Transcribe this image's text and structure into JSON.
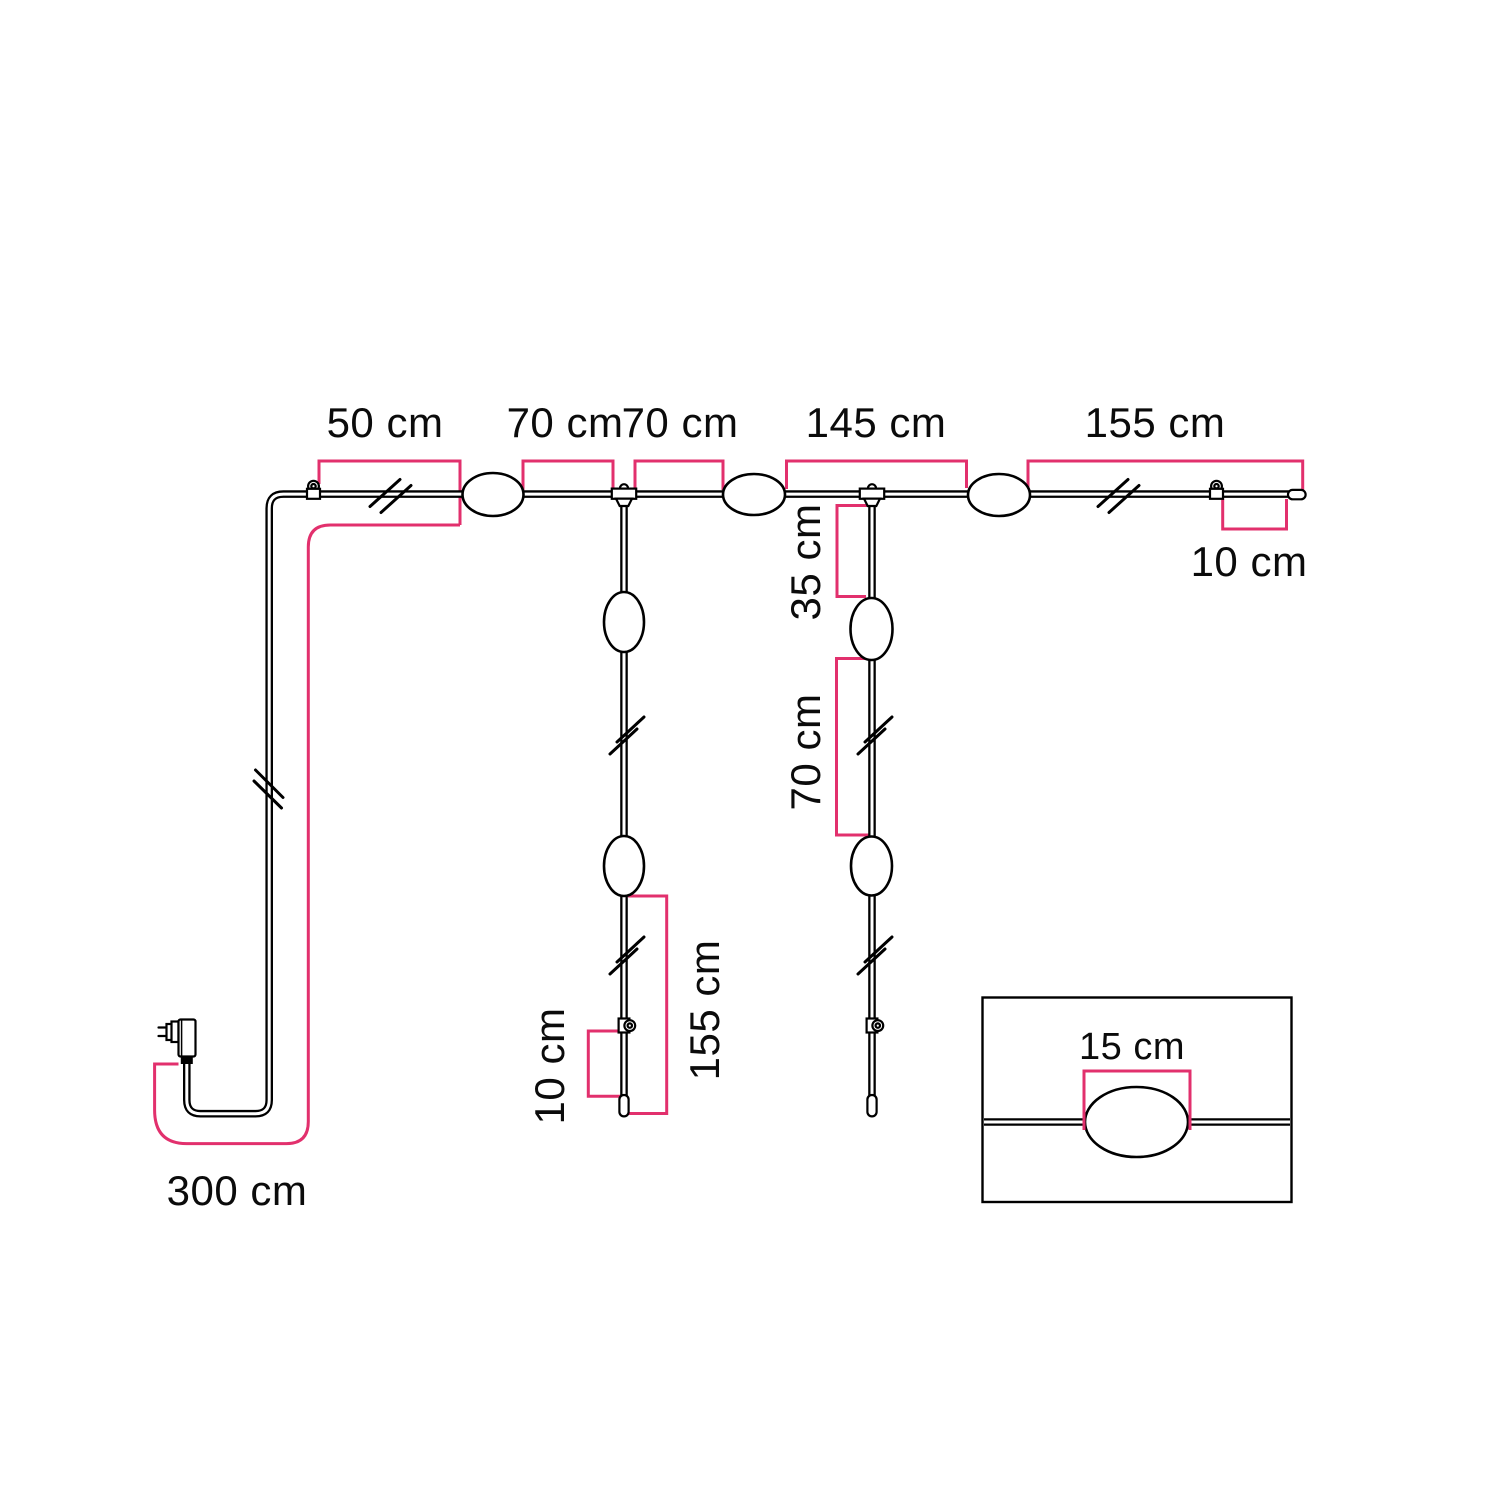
{
  "colors": {
    "accent": "#e2306d",
    "line": "#000000",
    "background": "#ffffff"
  },
  "unit": "cm",
  "dimensions": [
    {
      "id": "wall-hook-to-first-lamp",
      "value": 50,
      "label": "50 cm"
    },
    {
      "id": "first-lamp-to-tee",
      "value": 70,
      "label": "70 cm"
    },
    {
      "id": "tee-to-second-lamp",
      "value": 70,
      "label": "70 cm"
    },
    {
      "id": "second-lamp-to-third-lamp",
      "value": 145,
      "label": "145 cm"
    },
    {
      "id": "third-lamp-to-cable-end",
      "value": 155,
      "label": "155 cm"
    },
    {
      "id": "end-hook-to-tip",
      "value": 10,
      "label": "10 cm"
    },
    {
      "id": "tee-to-drop-lamp",
      "value": 35,
      "label": "35 cm"
    },
    {
      "id": "drop-lamp-to-drop-lamp",
      "value": 70,
      "label": "70 cm"
    },
    {
      "id": "drop-lamp-to-drop-tip",
      "value": 155,
      "label": "155 cm"
    },
    {
      "id": "drop-hook-to-drop-tip",
      "value": 10,
      "label": "10 cm"
    },
    {
      "id": "plug-lead-cable",
      "value": 300,
      "label": "300 cm"
    },
    {
      "id": "lamp-length-inset",
      "value": 15,
      "label": "15 cm"
    }
  ]
}
